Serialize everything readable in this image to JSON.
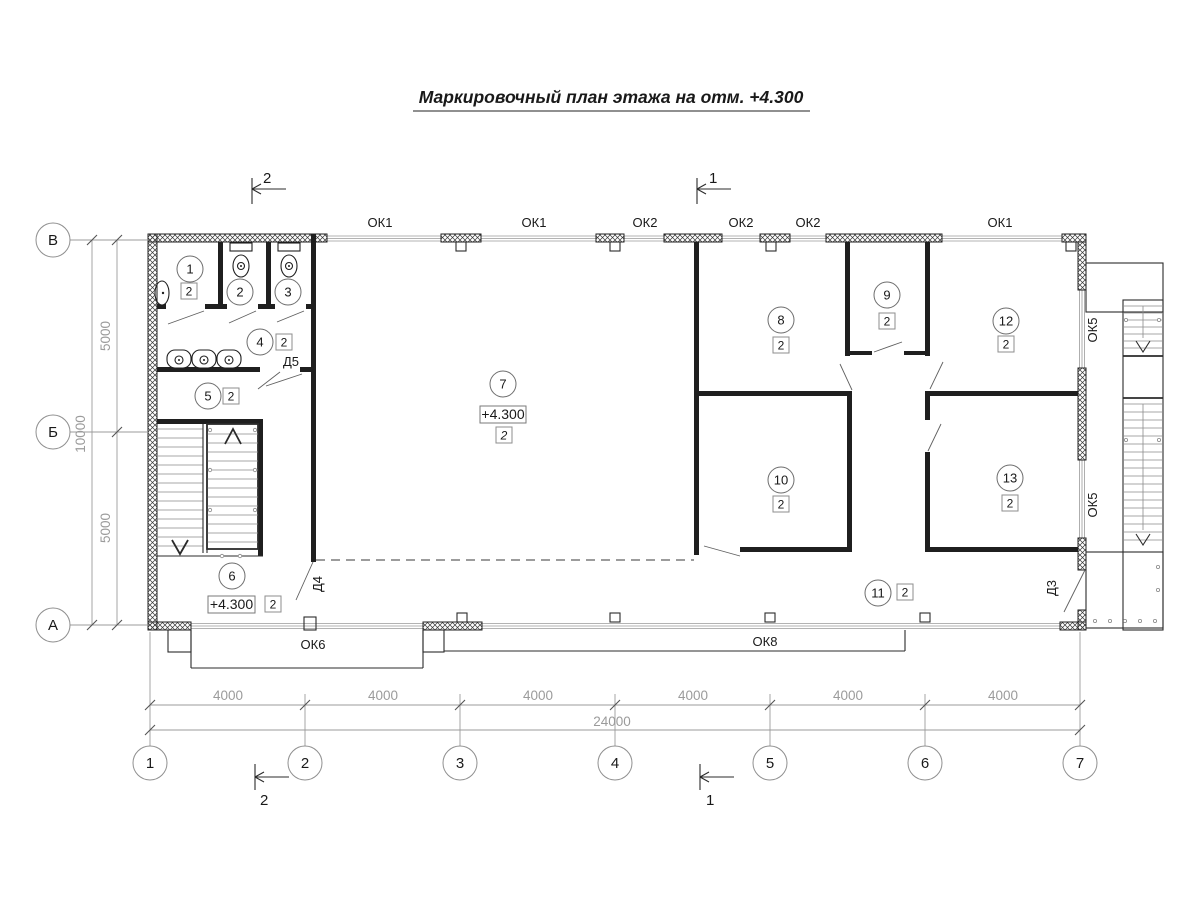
{
  "title": "Маркировочный план этажа на отм. +4.300",
  "section_marks": {
    "top_left": "2",
    "top_right": "1",
    "bottom_left": "2",
    "bottom_right": "1"
  },
  "axes_bottom": [
    "1",
    "2",
    "3",
    "4",
    "5",
    "6",
    "7"
  ],
  "axes_left": [
    "В",
    "Б",
    "А"
  ],
  "dims": {
    "b1": "4000",
    "b2": "4000",
    "b3": "4000",
    "b4": "4000",
    "b5": "4000",
    "b6": "4000",
    "b_total": "24000",
    "l1": "5000",
    "l2": "5000",
    "l_total": "10000"
  },
  "windows": {
    "t1": "ОК1",
    "t2": "ОК1",
    "t3": "ОК2",
    "t4": "ОК2",
    "t5": "ОК2",
    "t6": "ОК1",
    "bot1": "ОК6",
    "bot2": "ОК8",
    "r1": "ОК5",
    "r2": "ОК5"
  },
  "doors": {
    "d5": "Д5",
    "d4": "Д4",
    "d3": "Д3"
  },
  "rooms": {
    "r1": {
      "num": "1",
      "cls": "2"
    },
    "r2": {
      "num": "2"
    },
    "r3": {
      "num": "3"
    },
    "r4": {
      "num": "4",
      "cls": "2"
    },
    "r5": {
      "num": "5",
      "cls": "2"
    },
    "r6": {
      "num": "6",
      "cls": "2",
      "elev": "+4.300"
    },
    "r7": {
      "num": "7",
      "cls": "2",
      "elev": "+4.300"
    },
    "r8": {
      "num": "8",
      "cls": "2"
    },
    "r9": {
      "num": "9",
      "cls": "2"
    },
    "r10": {
      "num": "10",
      "cls": "2"
    },
    "r11": {
      "num": "11",
      "cls": "2"
    },
    "r12": {
      "num": "12",
      "cls": "2"
    },
    "r13": {
      "num": "13",
      "cls": "2"
    }
  }
}
